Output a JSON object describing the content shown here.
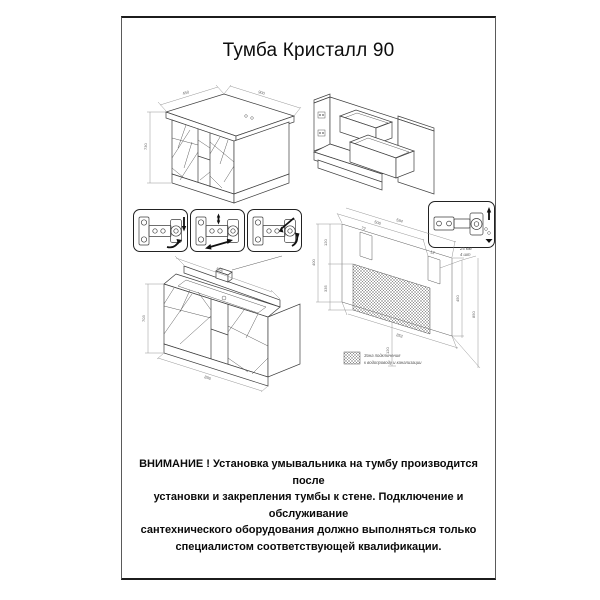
{
  "title": "Тумба Кристалл 90",
  "warning": {
    "line1": "ВНИМАНИЕ ! Установка умывальника на тумбу производится после",
    "line2": "установки и закрепления тумбы к стене. Подключение и обслуживание",
    "line3": "сантехнического оборудования должно выполняться только",
    "line4": "специалистом соответствующей квалификации."
  },
  "colors": {
    "line": "#3f3f3f",
    "dim_line": "#8a8a8a",
    "hatch": "#8a8a8a",
    "text": "#0d0d0d"
  },
  "closed_cabinet": {
    "dim_depth": "450",
    "dim_width": "900",
    "dim_height": "730"
  },
  "rear_view": {
    "dim_top": "556",
    "dim_height": "703",
    "dim_bottom": "896"
  },
  "wall_template": {
    "dim_top_left": "506",
    "dim_top": "594",
    "dim_left_upper": "120",
    "dim_left_mid": "335",
    "dim_far_left": "400",
    "dim_right": "450",
    "dim_far_right": "850",
    "dim_bottom": "852",
    "dim_bottom_center": "120",
    "slot_dim_left": "72",
    "slot_dim_right": "12",
    "note_line1": "25 мм",
    "note_line2": "4 шт",
    "legend_line1": "Зона подключения",
    "legend_line2": "к водопроводу и канализации"
  }
}
